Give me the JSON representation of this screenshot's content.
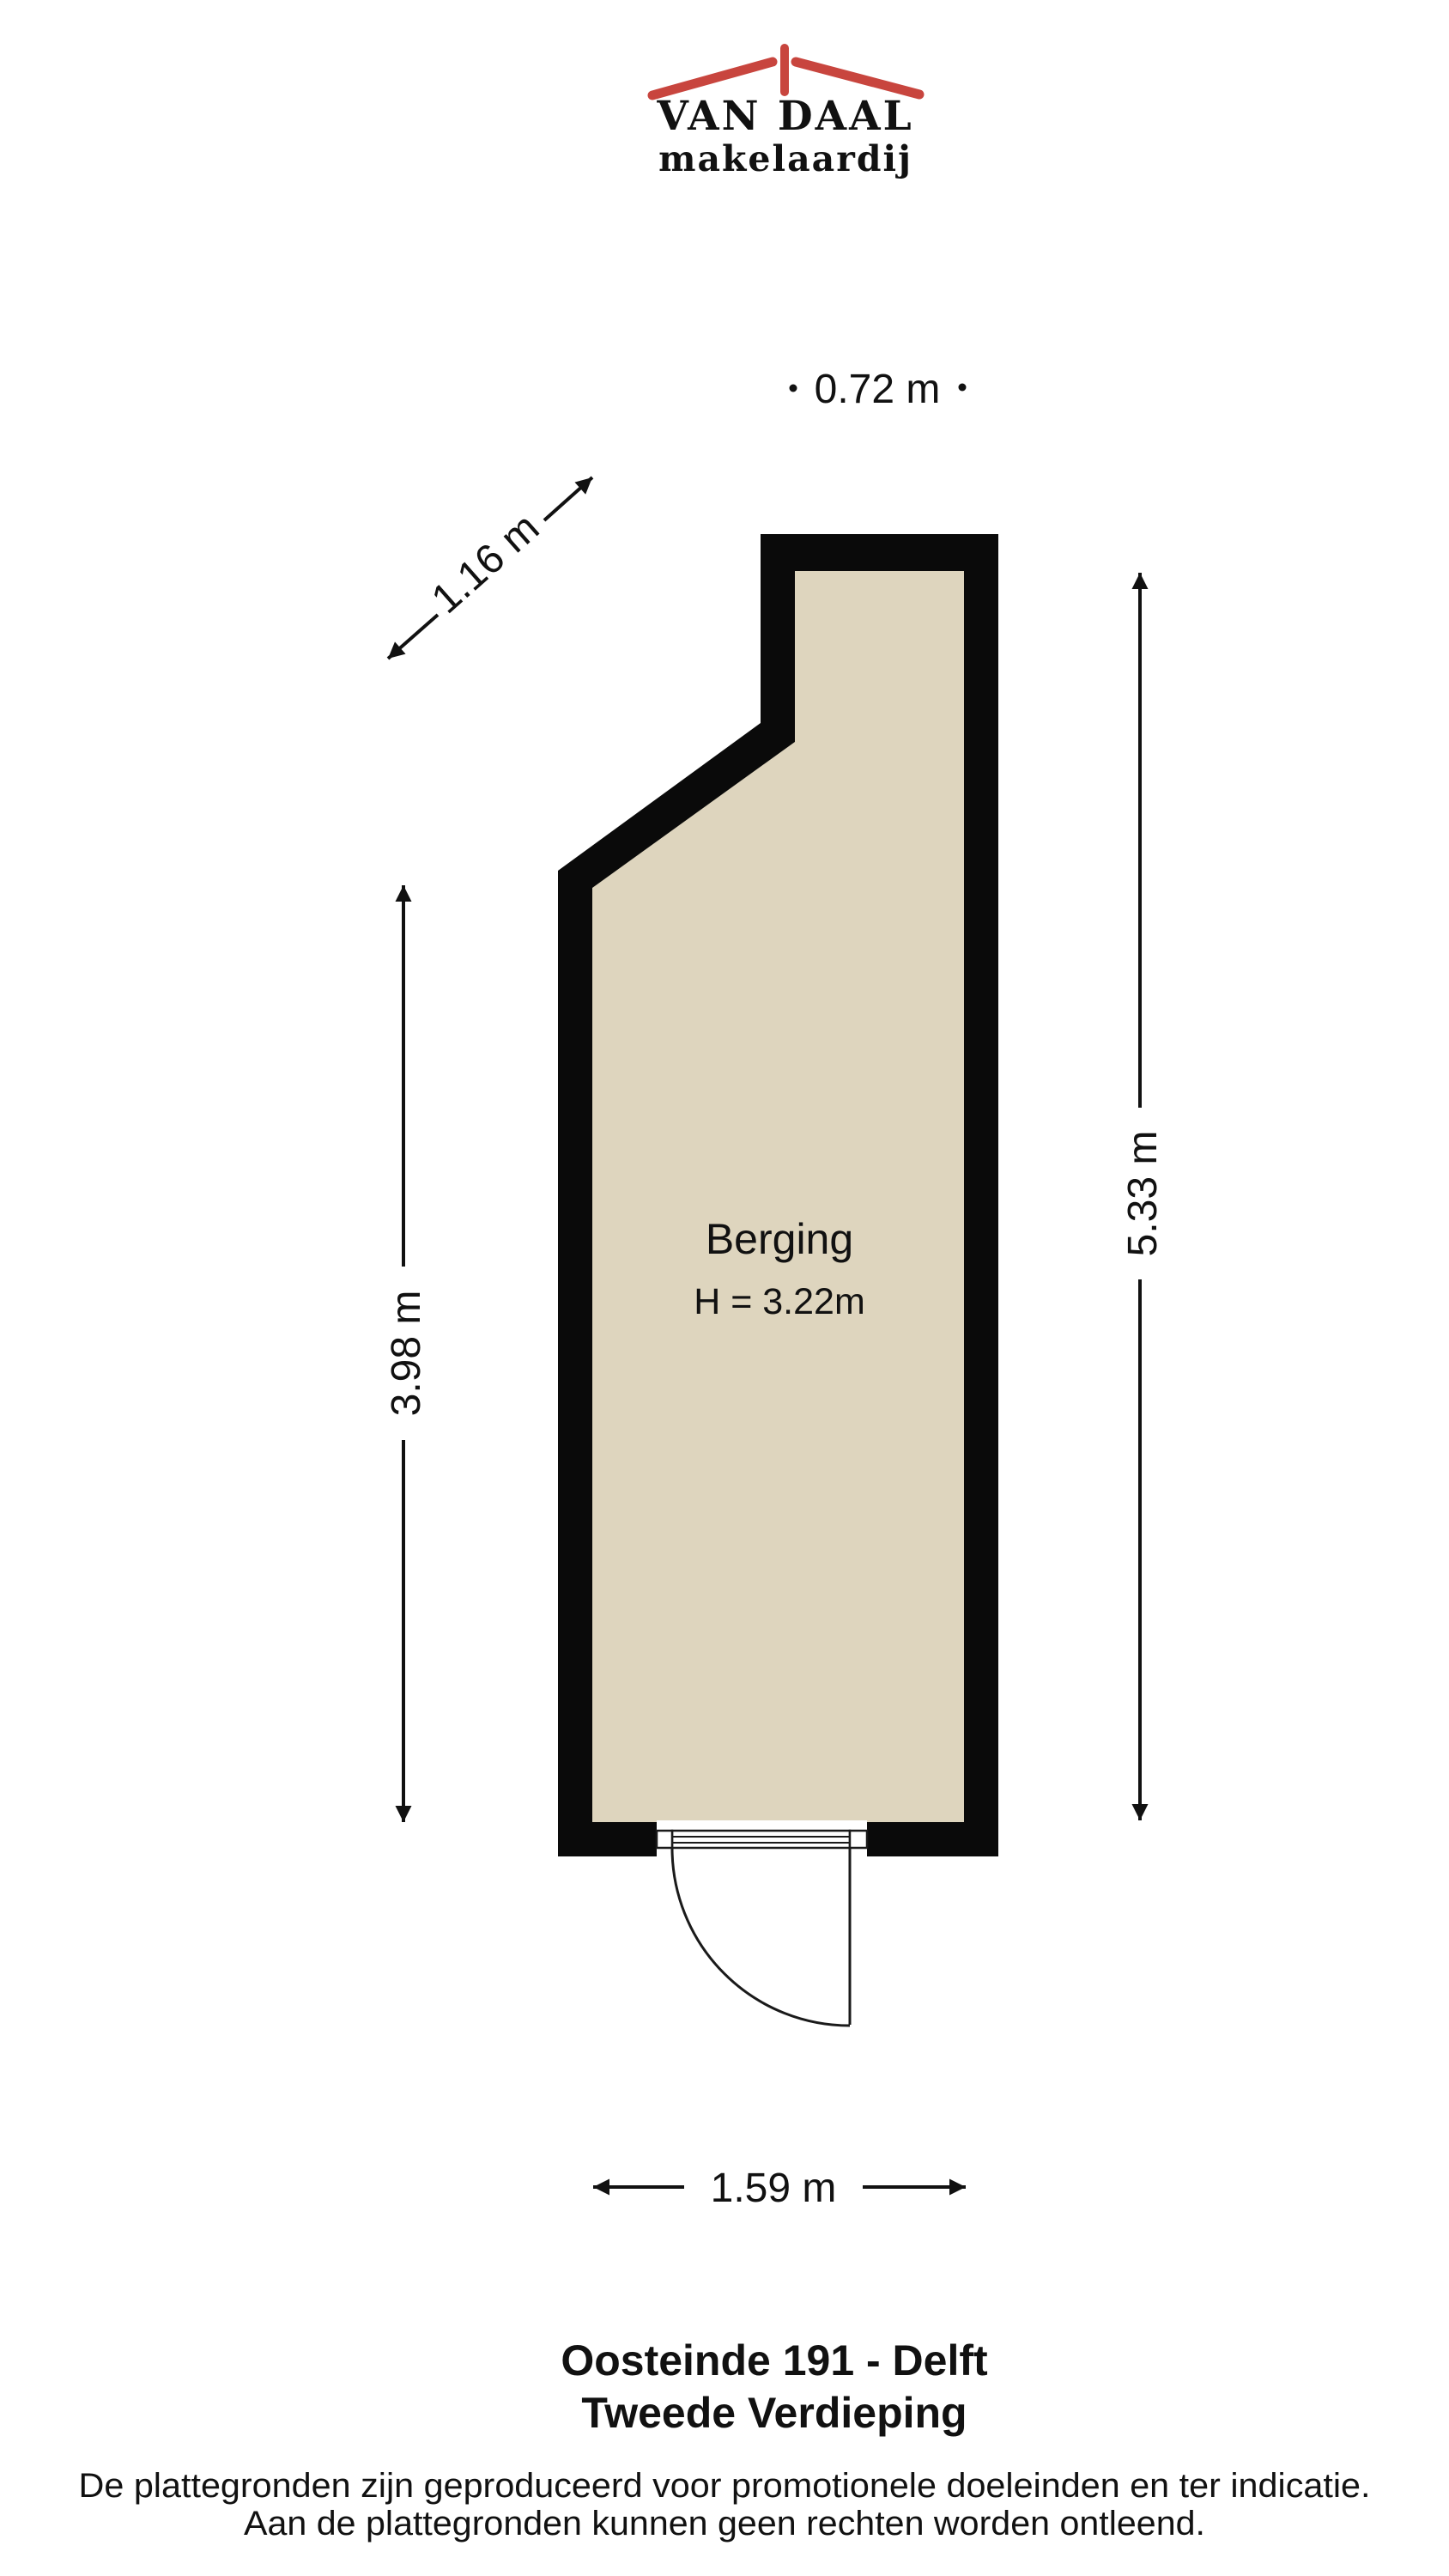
{
  "logo": {
    "name_line": "VAN DAAL",
    "sub_line": "makelaardij",
    "brand_blue": "#2a4779",
    "brand_red": "#c8453e"
  },
  "floorplan": {
    "room_label": "Berging",
    "room_height_label": "H = 3.22m",
    "wall_color": "#0a0a0a",
    "floor_color": "#ded5be",
    "dimensions": {
      "top_width": "0.72 m",
      "diagonal": "1.16 m",
      "left_height": "3.98 m",
      "right_height": "5.33 m",
      "bottom_width": "1.59 m"
    }
  },
  "title": {
    "line1": "Oosteinde 191 - Delft",
    "line2": "Tweede Verdieping"
  },
  "footer": {
    "line1": "De plattegronden zijn geproduceerd voor promotionele doeleinden en ter indicatie.",
    "line2": "Aan de plattegronden kunnen geen rechten worden ontleend."
  }
}
